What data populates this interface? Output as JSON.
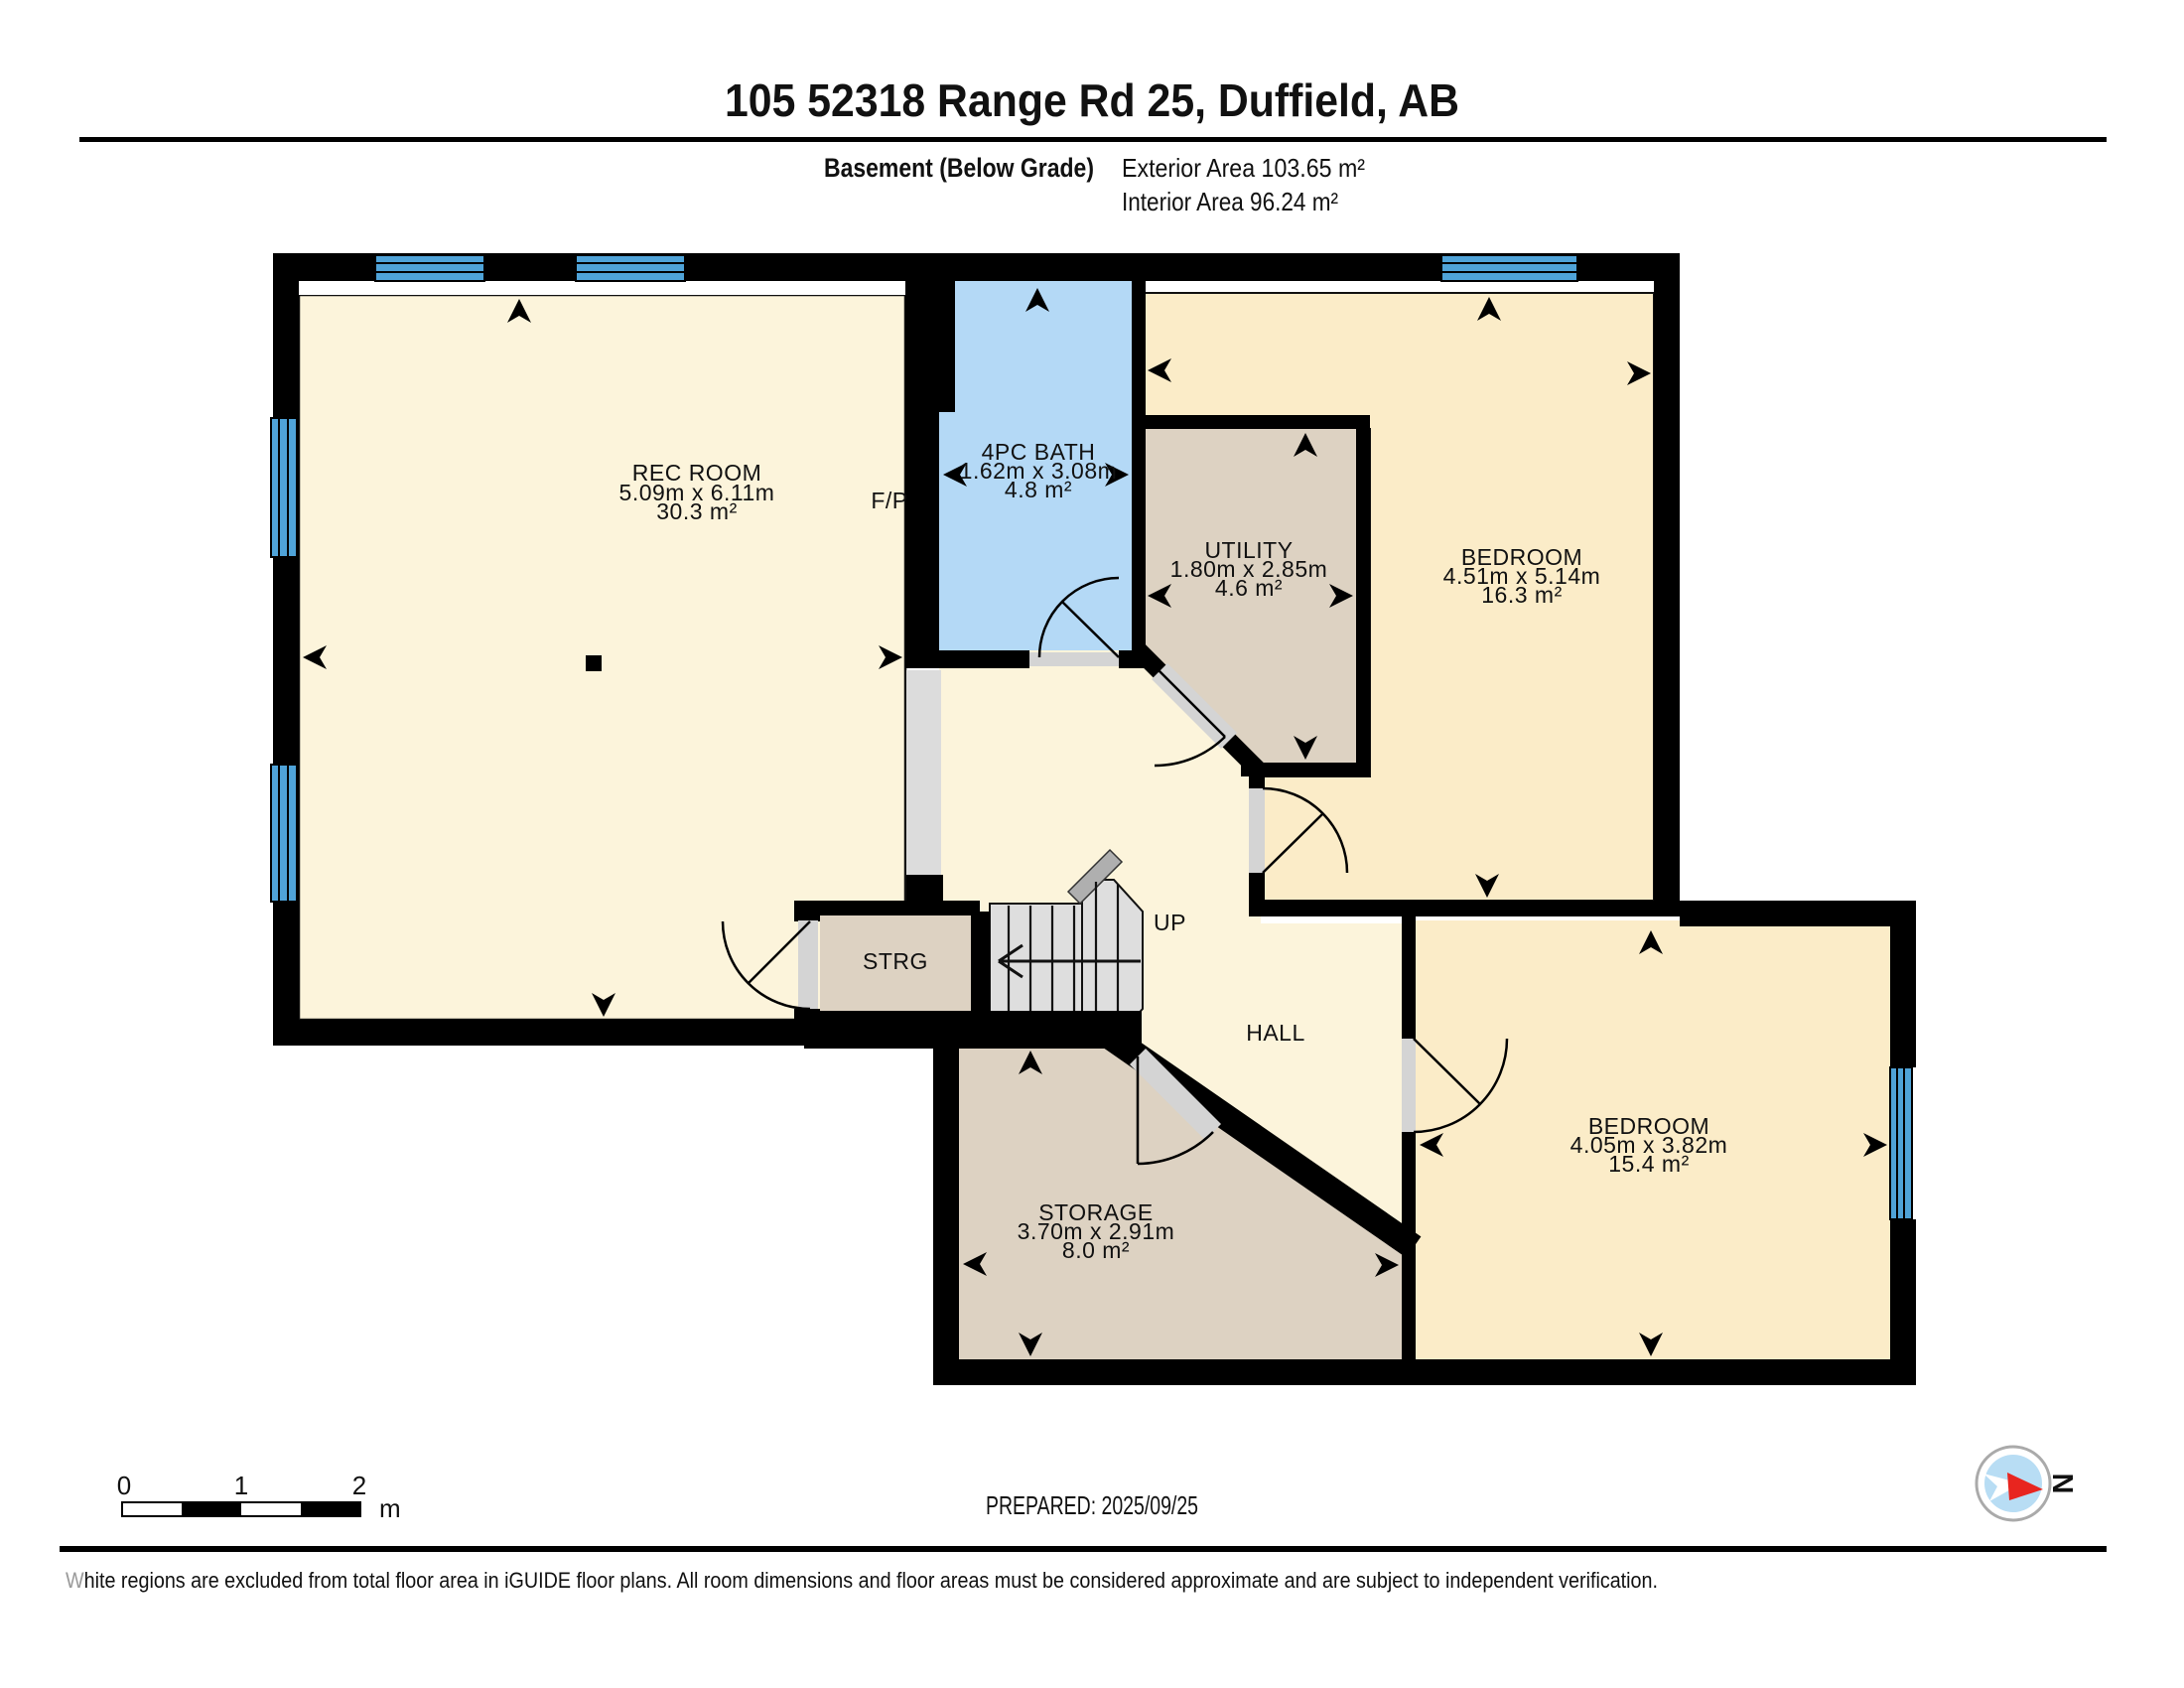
{
  "header": {
    "title": "105 52318 Range Rd 25, Duffield, AB",
    "floor_label": "Basement (Below Grade)",
    "exterior_area": "Exterior Area 103.65 m²",
    "interior_area": "Interior Area 96.24 m²"
  },
  "rooms": {
    "rec_room": {
      "name": "REC ROOM",
      "dims": "5.09m x 6.11m",
      "area": "30.3 m²"
    },
    "bath": {
      "name": "4PC BATH",
      "dims": "1.62m x 3.08m",
      "area": "4.8 m²"
    },
    "utility": {
      "name": "UTILITY",
      "dims": "1.80m x 2.85m",
      "area": "4.6 m²"
    },
    "bedroom1": {
      "name": "BEDROOM",
      "dims": "4.51m x 5.14m",
      "area": "16.3 m²"
    },
    "bedroom2": {
      "name": "BEDROOM",
      "dims": "4.05m x 3.82m",
      "area": "15.4 m²"
    },
    "storage": {
      "name": "STORAGE",
      "dims": "3.70m x 2.91m",
      "area": "8.0 m²"
    },
    "strg": {
      "name": "STRG"
    },
    "hall": {
      "name": "HALL"
    },
    "fireplace": {
      "name": "F/P"
    },
    "stairs": {
      "name": "UP"
    }
  },
  "scale_bar": {
    "tick0": "0",
    "tick1": "1",
    "tick2": "2",
    "unit": "m"
  },
  "footer": {
    "prepared": "PREPARED: 2025/09/25",
    "disclaimer": "White regions are excluded from total floor area in iGUIDE floor plans. All room dimensions and floor areas must be considered approximate and are subject to independent verification.",
    "compass_label": "N"
  },
  "colors": {
    "wall": "#000000",
    "floor_cream": "#FCF4DB",
    "floor_cream_warm": "#FBECC8",
    "floor_tan": "#DDD2C2",
    "floor_bath": "#B4D9F6",
    "window_blue": "#4FA3D8",
    "stairs_gray": "#DEDEDE",
    "door_gray": "#D4D4D4",
    "compass_red": "#E8251F",
    "compass_blue": "#B8DDF4"
  }
}
